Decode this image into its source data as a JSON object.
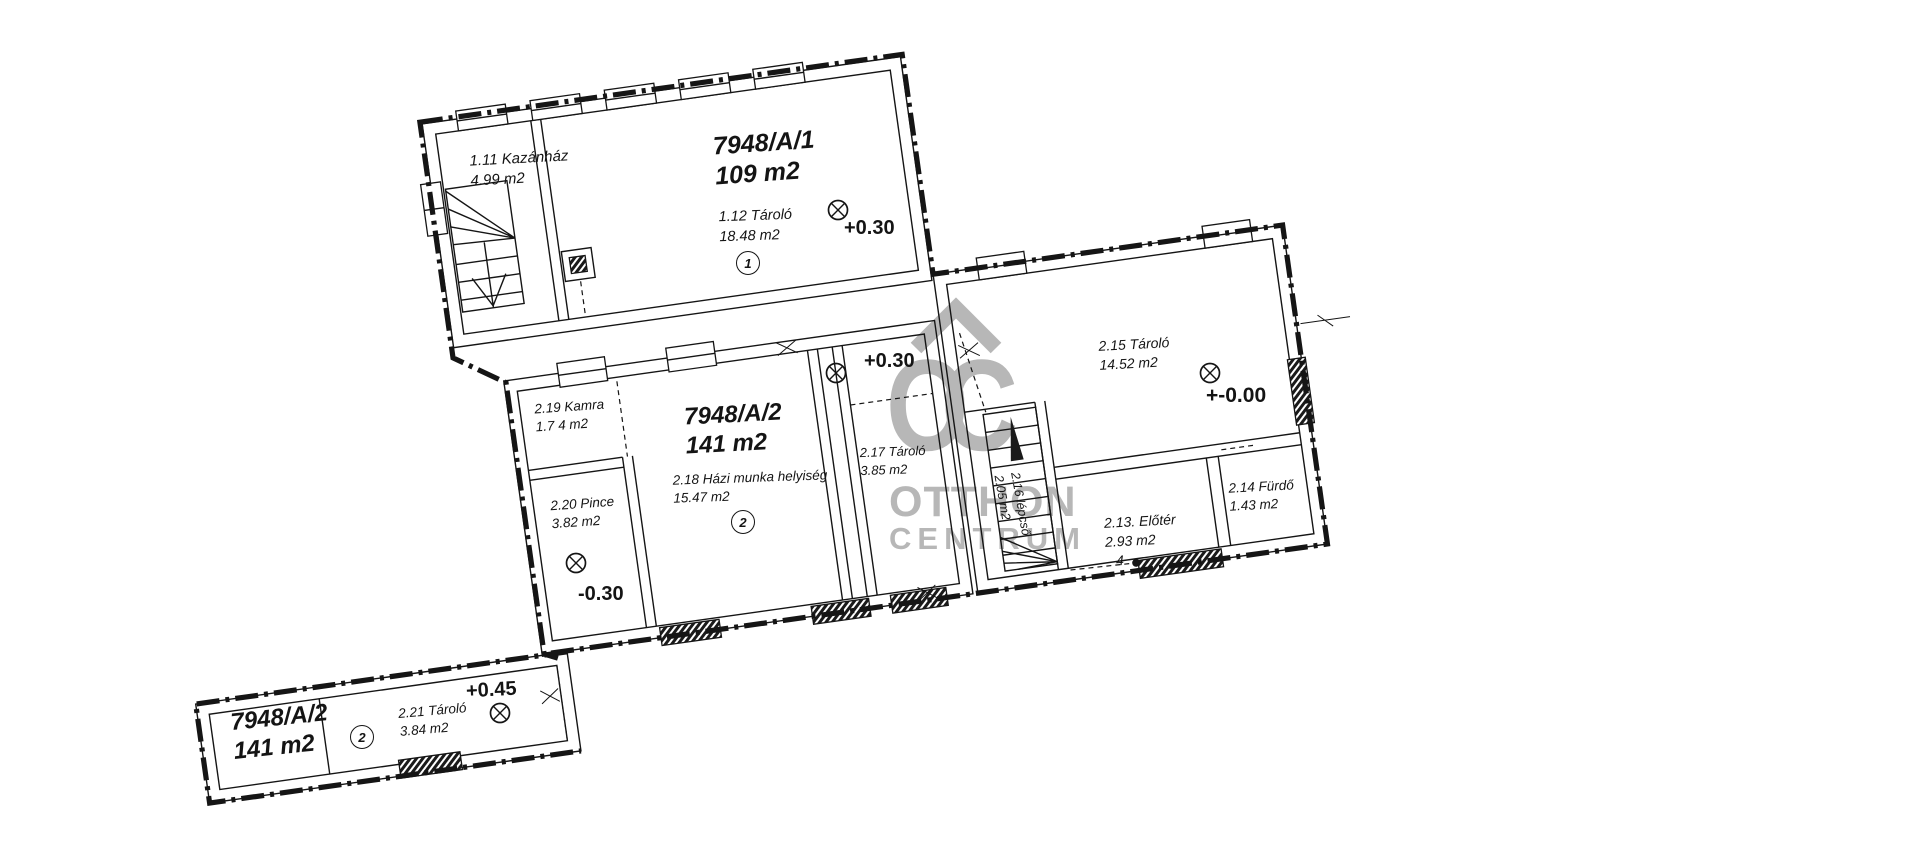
{
  "watermark": {
    "monogram": "OC",
    "brand_line1": "OTTHON",
    "brand_line2": "CENTRUM"
  },
  "units": {
    "a1": {
      "parcel": "7948/A/1",
      "area": "109 m2",
      "badge": "1"
    },
    "a2": {
      "parcel": "7948/A/2",
      "area": "141 m2",
      "badge": "2"
    },
    "a2_annex": {
      "parcel": "7948/A/2",
      "area": "141 m2",
      "badge": "2"
    }
  },
  "rooms": {
    "r111": {
      "name": "1.11 Kazánház",
      "area": "4.99 m2"
    },
    "r112": {
      "name": "1.12  Tároló",
      "area": "18.48 m2"
    },
    "r213": {
      "name": "2.13. Előtér",
      "area": "2.93 m2",
      "note": "4"
    },
    "r214": {
      "name": "2.14 Fürdő",
      "area": "1.43 m2"
    },
    "r215": {
      "name": "2.15 Tároló",
      "area": "14.52 m2"
    },
    "r216": {
      "name": "2.16 lépcső",
      "area": "2.05 m2"
    },
    "r217": {
      "name": "2.17 Tároló",
      "area": "3.85 m2"
    },
    "r218": {
      "name": "2.18  Házi munka helyiség",
      "area": "15.47 m2"
    },
    "r219": {
      "name": "2.19 Kamra",
      "area": "1.7 4 m2"
    },
    "r220": {
      "name": "2.20 Pince",
      "area": "3.82 m2"
    },
    "r221": {
      "name": "2.21 Tároló",
      "area": "3.84 m2"
    }
  },
  "elevations": {
    "a1_storage": "+0.30",
    "a2_corridor": "+0.30",
    "a2_ground": "+-0.00",
    "a2_cellar": "-0.30",
    "a2_annex": "+0.45"
  }
}
